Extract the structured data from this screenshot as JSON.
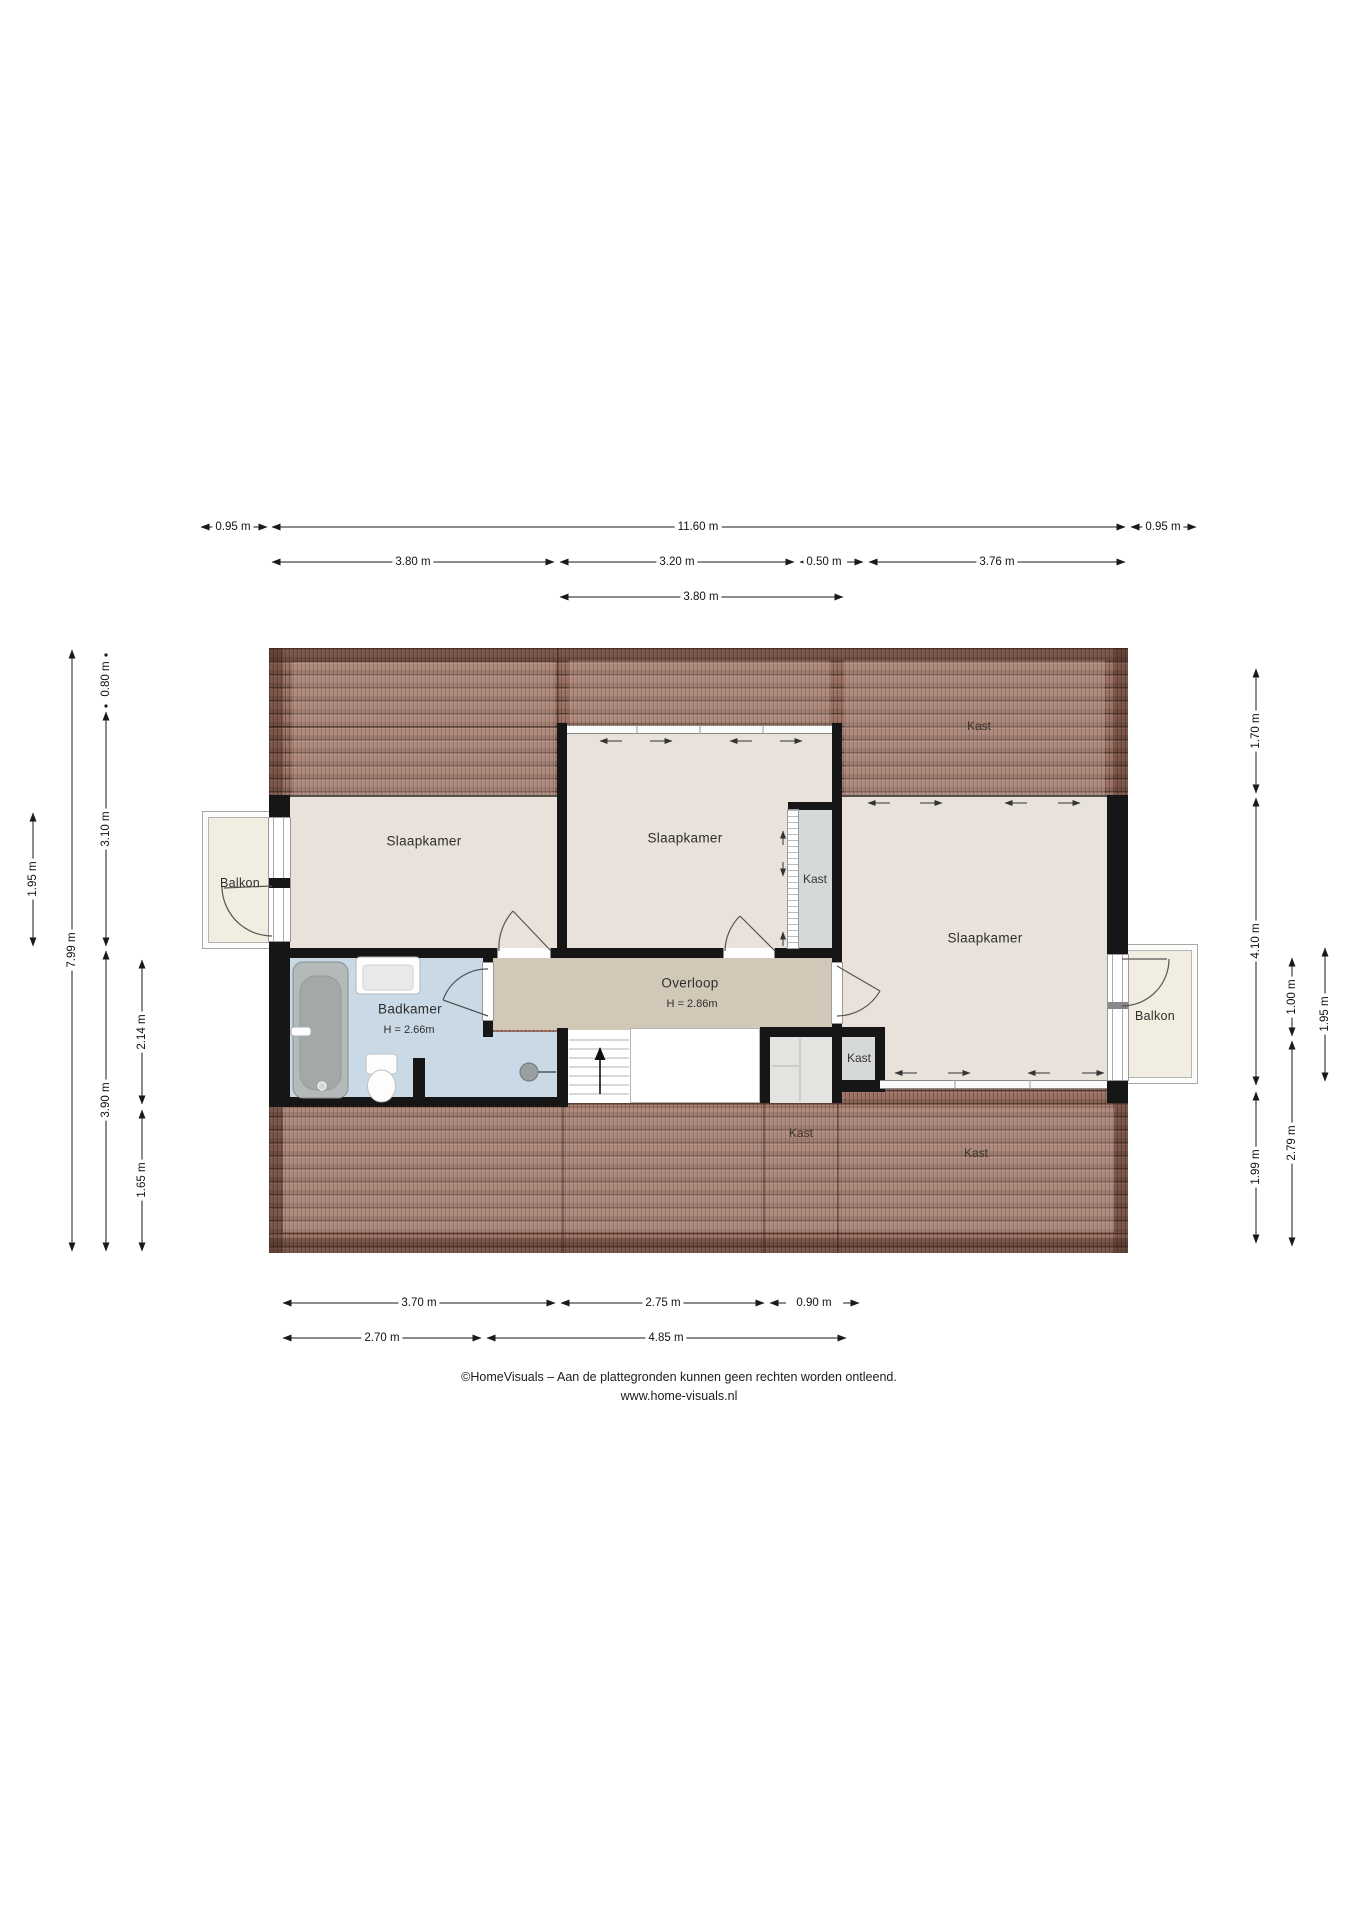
{
  "page": {
    "width_px": 1358,
    "height_px": 1920,
    "type": "floor-plan"
  },
  "colors": {
    "roof_tile": "#9c7265",
    "roof_tile_line": "#5a3b2f",
    "floor_room": "#e8e2da",
    "floor_landing": "#d2c8b8",
    "floor_bathroom": "#c9dae6",
    "closet_fill": "#d5d9d9",
    "balcony_fill": "#f1eee1",
    "wall": "#161616",
    "dimension_text": "#111111"
  },
  "rooms": {
    "bedroom_left": "Slaapkamer",
    "bedroom_middle": "Slaapkamer",
    "bedroom_right": "Slaapkamer",
    "bathroom": "Badkamer",
    "bathroom_ceiling": "H = 2.66m",
    "landing": "Overloop",
    "landing_ceiling": "H = 2.86m",
    "balcony_left": "Balkon",
    "balcony_right": "Balkon",
    "closet_bedroom": "Kast",
    "closet_landing": "Kast",
    "closet_attic_top_right": "Kast",
    "closet_attic_bottom_middle": "Kast",
    "closet_attic_bottom_right": "Kast"
  },
  "dimensions": {
    "h_top": [
      "0.95 m",
      "11.60 m",
      "0.95 m",
      "3.80 m",
      "3.20 m",
      "0.50 m",
      "3.76 m",
      "3.80 m"
    ],
    "h_bottom": [
      "3.70 m",
      "2.75 m",
      "0.90 m",
      "2.70 m",
      "4.85 m"
    ],
    "v_left": [
      "1.95 m",
      "7.99 m",
      "0.80 m",
      "3.10 m",
      "3.90 m",
      "2.14 m",
      "1.65 m"
    ],
    "v_right": [
      "1.70 m",
      "4.10 m",
      "1.99 m",
      "1.00 m",
      "2.79 m",
      "1.95 m"
    ]
  },
  "footer": {
    "line1": "©HomeVisuals – Aan de plattegronden kunnen geen rechten worden ontleend.",
    "line2": "www.home-visuals.nl"
  }
}
